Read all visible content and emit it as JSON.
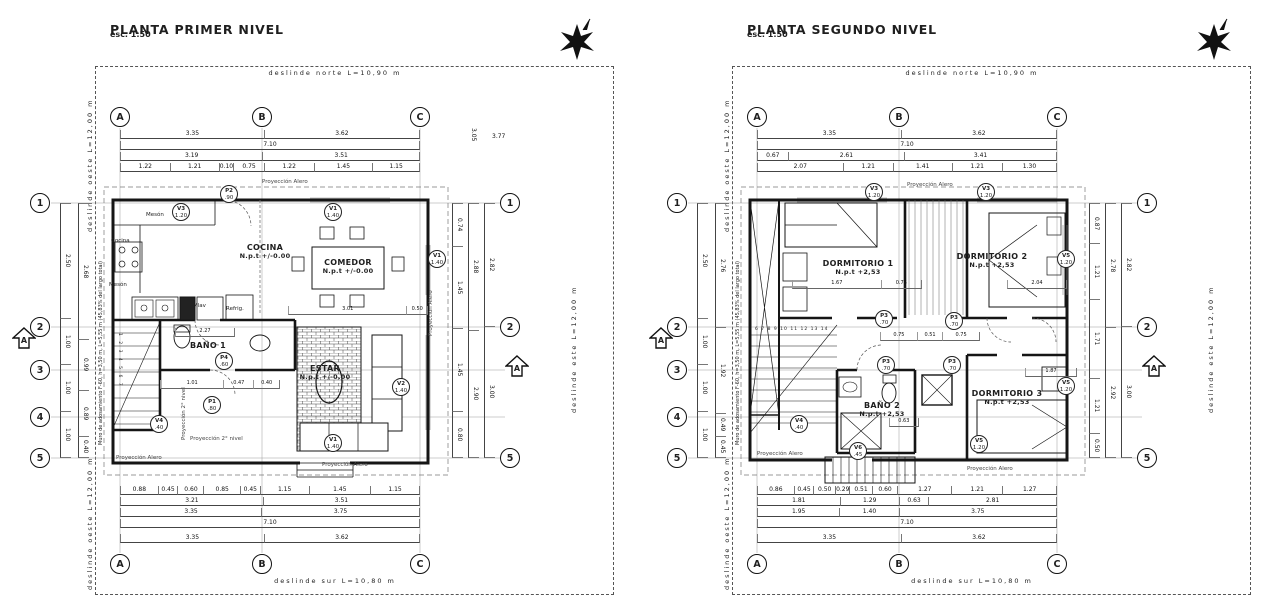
{
  "page": {
    "paper_color": "#ffffff",
    "ink_color": "#1f1f1f"
  },
  "plans": [
    {
      "title": "PLANTA PRIMER NIVEL",
      "scale": "esc. 1:50",
      "deslinde": {
        "norte": "deslinde norte L=10,90 m",
        "sur": "deslinde sur L=10,80 m",
        "oeste": "deslinde oeste L=12,00 m",
        "este": "deslinde este L=12,00 m"
      },
      "grid_cols": [
        "A",
        "B",
        "C"
      ],
      "grid_rows": [
        "1",
        "2",
        "3",
        "4",
        "5"
      ],
      "grid_rows_right": [
        "1",
        "2",
        "5"
      ],
      "section_label": "A",
      "muro_note": "Muro de adosamiento F-60, h=3,50 m, L=5,55 m (45,83% del largo total)",
      "proyeccion": {
        "alero": "Proyección Alero",
        "segundo_nivel": "Proyección 2° nivel"
      },
      "rooms": [
        {
          "name": "COCINA",
          "level": "N.p.t +/-0.00"
        },
        {
          "name": "COMEDOR",
          "level": "N.p.t +/-0.00"
        },
        {
          "name": "BAÑO 1",
          "level": ""
        },
        {
          "name": "ESTAR",
          "level": "N.p.t +/-0.00"
        }
      ],
      "fixtures": [
        "Mesón",
        "Mesón",
        "Cocina",
        "Mlav",
        "Refrig."
      ],
      "tags": [
        {
          "name": "V3",
          "size": "1.20"
        },
        {
          "name": "P2",
          "size": ".90"
        },
        {
          "name": "V1",
          "size": "1.40"
        },
        {
          "name": "V1",
          "size": "1.40"
        },
        {
          "name": "V2",
          "size": "1.40"
        },
        {
          "name": "V1",
          "size": "1.40"
        },
        {
          "name": "V4",
          "size": ".40"
        },
        {
          "name": "P1",
          "size": ".80"
        },
        {
          "name": "P4",
          "size": ".60"
        }
      ],
      "stair_numbers": "1 2 3 4 5 6 7",
      "dims_top": [
        [
          "3.35",
          "3.62"
        ],
        [
          "7.10"
        ],
        [
          "3.19",
          "3.51"
        ],
        [
          "1.22",
          "1.21",
          "0.10",
          "0.75",
          "1.22",
          "1.45",
          "1.15"
        ]
      ],
      "dims_bottom": [
        [
          "0.88",
          "0.45",
          "0.60",
          "0.85",
          "0.45",
          "1.15",
          "1.45",
          "1.15"
        ],
        [
          "3.21",
          "3.51"
        ],
        [
          "3.35",
          "3.75"
        ],
        [
          "7.10"
        ],
        [
          "3.35",
          "3.62"
        ]
      ],
      "dims_left": [
        [
          "2.50",
          "1.00",
          "1.00",
          "1.00"
        ],
        [
          "2.68",
          "0.99",
          "0.89",
          "0.40"
        ]
      ],
      "dims_right": [
        [
          "0.74",
          "1.45",
          "1.45",
          "0.80"
        ],
        [
          "2.88",
          "2.90"
        ],
        [
          "2.82",
          "3.00"
        ]
      ],
      "dims_extra": [
        "3.05",
        "3.77"
      ],
      "dims_interior": {
        "comedor": [
          "3.01",
          "0.50"
        ],
        "bano": [
          "2.27"
        ],
        "hall": [
          "1.01",
          "0.47",
          "0.40"
        ]
      }
    },
    {
      "title": "PLANTA SEGUNDO NIVEL",
      "scale": "esc. 1:50",
      "deslinde": {
        "norte": "deslinde norte L=10,90 m",
        "sur": "deslinde sur L=10,80 m",
        "oeste": "deslinde oeste L=12,00 m",
        "este": "deslinde este L=12,00 m"
      },
      "grid_cols": [
        "A",
        "B",
        "C"
      ],
      "grid_rows": [
        "1",
        "2",
        "3",
        "4",
        "5"
      ],
      "grid_rows_right": [
        "1",
        "2",
        "5"
      ],
      "section_label": "A",
      "muro_note": "Muro de adosamiento F-60, h=3,50 m, L=5,55 m (45,83% del largo total)",
      "proyeccion": {
        "alero": "Proyección Alero",
        "segundo_nivel": ""
      },
      "rooms": [
        {
          "name": "DORMITORIO 1",
          "level": "N.p.t +2,53"
        },
        {
          "name": "DORMITORIO 2",
          "level": "N.p.t +2,53"
        },
        {
          "name": "BAÑO 2",
          "level": "N.p.t +2,53"
        },
        {
          "name": "DORMITORIO 3",
          "level": "N.p.t +2,53"
        }
      ],
      "fixtures": [],
      "tags": [
        {
          "name": "V3",
          "size": "1.20"
        },
        {
          "name": "V3",
          "size": "1.20"
        },
        {
          "name": "V5",
          "size": "1.20"
        },
        {
          "name": "V5",
          "size": "1.20"
        },
        {
          "name": "V5",
          "size": "1.20"
        },
        {
          "name": "V4",
          "size": ".40"
        },
        {
          "name": "V6",
          "size": ".45"
        },
        {
          "name": "P3",
          "size": ".70"
        },
        {
          "name": "P3",
          "size": ".70"
        },
        {
          "name": "P3",
          "size": ".70"
        },
        {
          "name": "P3",
          "size": ".70"
        }
      ],
      "stair_numbers": "6 7 8 9 10 11 12 13 14",
      "dims_top": [
        [
          "3.35",
          "3.62"
        ],
        [
          "7.10"
        ],
        [
          "0.67",
          "2.61",
          "3.41"
        ],
        [
          "2.07",
          "1.21",
          "1.41",
          "1.21",
          "1.30"
        ]
      ],
      "dims_bottom": [
        [
          "0.86",
          "0.45",
          "0.50",
          "0.29",
          "0.51",
          "0.60",
          "1.27",
          "1.21",
          "1.27"
        ],
        [
          "1.81",
          "1.29",
          "0.63",
          "2.81"
        ],
        [
          "1.95",
          "1.40",
          "3.75"
        ],
        [
          "7.10"
        ],
        [
          "3.35",
          "3.62"
        ]
      ],
      "dims_left": [
        [
          "2.50",
          "1.00",
          "1.00",
          "1.00"
        ],
        [
          "2.76",
          "1.92",
          "0.49",
          "0.45"
        ]
      ],
      "dims_right": [
        [
          "0.87",
          "1.21",
          "1.71",
          "1.21",
          "0.50"
        ],
        [
          "2.78",
          "2.92"
        ],
        [
          "2.82",
          "3.00"
        ]
      ],
      "dims_extra": [],
      "dims_interior": {
        "dorm1": [
          "1.67",
          "0.75"
        ],
        "dorm2": [
          "2.04"
        ],
        "hall": [
          "0.75",
          "0.51",
          "0.75"
        ],
        "dorm3": [
          "1.87"
        ],
        "bano": [
          "0.63"
        ]
      }
    }
  ]
}
